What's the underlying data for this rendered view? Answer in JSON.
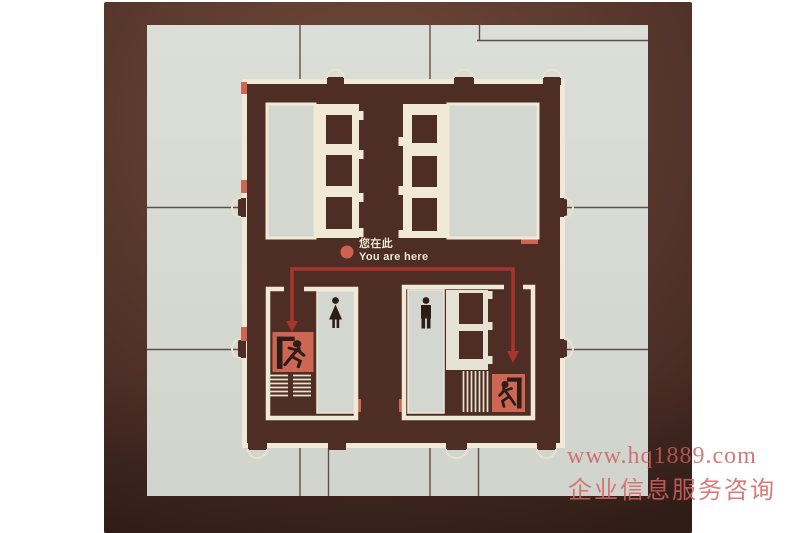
{
  "sign": {
    "you_are_here_zh": "您在此",
    "you_are_here_en": "You are here"
  },
  "watermark": {
    "url": "www.hq1889.com",
    "caption": "企业信息服务咨询"
  },
  "icons": {
    "exit_left": "running-man-exit-icon",
    "exit_right": "running-man-exit-icon",
    "womens_restroom": "woman-figure-icon",
    "mens_restroom": "man-figure-icon",
    "you_are_here_marker": "red-dot",
    "doors": "double-swing-door-arcs",
    "stairs_left": "horizontal-tread-stairs",
    "stairs_right": "vertical-tread-stairs"
  },
  "colors": {
    "photo_brown": "#5c3a2e",
    "plan_brown": "#4e2d25",
    "tile_gray": "#d6d9d2",
    "wall_cream": "#f0e9d6",
    "accent_salmon": "#cd6653",
    "arrow_red": "#a8342e",
    "figure_dark": "#2e1c17",
    "watermark_pink": "#cd6464"
  }
}
